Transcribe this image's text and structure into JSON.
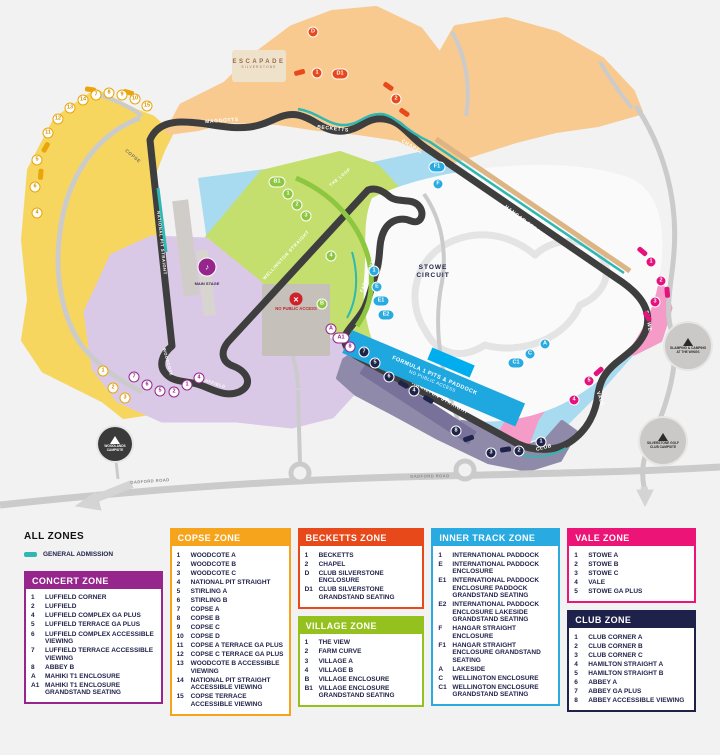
{
  "map": {
    "zone_colors": {
      "copse": "#E9A50A",
      "concert": "#96268C",
      "becketts": "#E8491B",
      "village": "#8DC63F",
      "inner": "#29ABE2",
      "vale": "#E5127D",
      "club": "#1F2349",
      "general_admission": "#2FB8B1"
    },
    "special": {
      "banner_line1": "FORMULA 1 PITS & PADDOCK",
      "banner_line2": "NO PUBLIC ACCESS",
      "stowe_line1": "STOWE",
      "stowe_line2": "CIRCUIT",
      "escapade_line1": "ESCAPADE",
      "escapade_line2": "SILVERSTONE",
      "main_stage": "MAIN STAGE",
      "no_access": "NO PUBLIC ACCESS"
    },
    "labels": [
      {
        "t": "MAGGOTTS",
        "x": 222,
        "y": 121,
        "r": -4,
        "c": "light",
        "s": 5
      },
      {
        "t": "BECKETTS",
        "x": 333,
        "y": 129,
        "r": 6,
        "c": "light",
        "s": 5
      },
      {
        "t": "CHAPEL",
        "x": 412,
        "y": 147,
        "r": 30,
        "c": "light",
        "s": 5
      },
      {
        "t": "HANGAR STRAIGHT",
        "x": 528,
        "y": 224,
        "r": 37,
        "c": "light",
        "s": 5
      },
      {
        "t": "STOWE",
        "x": 648,
        "y": 321,
        "r": 80,
        "c": "light",
        "s": 5
      },
      {
        "t": "VALE",
        "x": 600,
        "y": 399,
        "r": 72,
        "c": "light",
        "s": 5
      },
      {
        "t": "CLUB",
        "x": 544,
        "y": 448,
        "r": -14,
        "c": "light",
        "s": 5
      },
      {
        "t": "HAMILTON STRAIGHT",
        "x": 440,
        "y": 398,
        "r": 29,
        "c": "light",
        "s": 5
      },
      {
        "t": "WELLINGTON STRAIGHT",
        "x": 286,
        "y": 255,
        "r": -47,
        "c": "light",
        "s": 4.5
      },
      {
        "t": "THE LOOP",
        "x": 340,
        "y": 177,
        "r": -40,
        "c": "light",
        "s": 4.2
      },
      {
        "t": "FARM CURVE",
        "x": 367,
        "y": 276,
        "r": -70,
        "c": "light",
        "s": 4.2
      },
      {
        "t": "NATIONAL PIT STRAIGHT",
        "x": 162,
        "y": 243,
        "r": 84,
        "c": "light",
        "s": 4.2
      },
      {
        "t": "COPSE",
        "x": 133,
        "y": 156,
        "r": 40,
        "c": "dark",
        "s": 4.5
      },
      {
        "t": "LUFFIELD",
        "x": 214,
        "y": 383,
        "r": 18,
        "c": "light",
        "s": 4
      },
      {
        "t": "WOODCOTE",
        "x": 168,
        "y": 362,
        "r": 75,
        "c": "light",
        "s": 4
      },
      {
        "t": "DADFORD ROAD",
        "x": 150,
        "y": 481,
        "r": -4,
        "c": "roadlabel",
        "s": 4.2
      },
      {
        "t": "DADFORD ROAD",
        "x": 430,
        "y": 476,
        "r": -1,
        "c": "roadlabel",
        "s": 4.2
      }
    ],
    "markers": [
      {
        "z": "copse",
        "t": "11",
        "x": 48,
        "y": 133
      },
      {
        "z": "copse",
        "t": "12",
        "x": 58,
        "y": 119
      },
      {
        "z": "copse",
        "t": "13",
        "x": 70,
        "y": 108
      },
      {
        "z": "copse",
        "t": "14",
        "x": 83,
        "y": 100
      },
      {
        "z": "copse",
        "t": "7",
        "x": 96,
        "y": 95
      },
      {
        "z": "copse",
        "t": "8",
        "x": 109,
        "y": 93
      },
      {
        "z": "copse",
        "t": "9",
        "x": 122,
        "y": 95
      },
      {
        "z": "copse",
        "t": "10",
        "x": 135,
        "y": 99
      },
      {
        "z": "copse",
        "t": "15",
        "x": 147,
        "y": 106
      },
      {
        "z": "copse",
        "t": "5",
        "x": 37,
        "y": 160
      },
      {
        "z": "copse",
        "t": "6",
        "x": 35,
        "y": 187
      },
      {
        "z": "copse",
        "t": "4",
        "x": 37,
        "y": 213
      },
      {
        "z": "copse",
        "t": "1",
        "x": 103,
        "y": 371
      },
      {
        "z": "copse",
        "t": "2",
        "x": 113,
        "y": 388
      },
      {
        "z": "copse",
        "t": "3",
        "x": 125,
        "y": 398
      },
      {
        "z": "copse",
        "b": true,
        "x": 45,
        "y": 147,
        "r": -60
      },
      {
        "z": "copse",
        "b": true,
        "x": 90,
        "y": 89,
        "r": 8
      },
      {
        "z": "copse",
        "b": true,
        "x": 128,
        "y": 92,
        "r": 15
      },
      {
        "z": "copse",
        "b": true,
        "x": 40,
        "y": 174,
        "r": -85
      },
      {
        "z": "concert",
        "t": "7",
        "x": 134,
        "y": 377
      },
      {
        "z": "concert",
        "t": "6",
        "x": 147,
        "y": 385
      },
      {
        "z": "concert",
        "t": "5",
        "x": 160,
        "y": 391
      },
      {
        "z": "concert",
        "t": "2",
        "x": 174,
        "y": 392
      },
      {
        "z": "concert",
        "t": "1",
        "x": 187,
        "y": 385
      },
      {
        "z": "concert",
        "t": "4",
        "x": 199,
        "y": 378
      },
      {
        "z": "concert",
        "t": "8",
        "x": 350,
        "y": 347
      },
      {
        "z": "concert",
        "t": "A",
        "x": 331,
        "y": 329
      },
      {
        "z": "concert",
        "t": "A1",
        "x": 341,
        "y": 338,
        "p": true
      },
      {
        "z": "becketts",
        "t": "D",
        "x": 313,
        "y": 32
      },
      {
        "z": "becketts",
        "t": "1",
        "x": 317,
        "y": 73
      },
      {
        "z": "becketts",
        "t": "D1",
        "x": 340,
        "y": 74,
        "p": true
      },
      {
        "z": "becketts",
        "t": "2",
        "x": 396,
        "y": 99
      },
      {
        "z": "becketts",
        "b": true,
        "x": 299,
        "y": 72,
        "r": -15
      },
      {
        "z": "becketts",
        "b": true,
        "x": 388,
        "y": 86,
        "r": 35
      },
      {
        "z": "becketts",
        "b": true,
        "x": 404,
        "y": 112,
        "r": 35
      },
      {
        "z": "village",
        "t": "B1",
        "x": 277,
        "y": 182,
        "p": true
      },
      {
        "z": "village",
        "t": "1",
        "x": 288,
        "y": 194
      },
      {
        "z": "village",
        "t": "2",
        "x": 297,
        "y": 205
      },
      {
        "z": "village",
        "t": "3",
        "x": 306,
        "y": 216
      },
      {
        "z": "village",
        "t": "4",
        "x": 331,
        "y": 256
      },
      {
        "z": "village",
        "t": "B",
        "x": 322,
        "y": 304
      },
      {
        "z": "inner",
        "t": "F1",
        "x": 437,
        "y": 167,
        "p": true
      },
      {
        "z": "inner",
        "t": "F",
        "x": 438,
        "y": 184
      },
      {
        "z": "inner",
        "t": "1",
        "x": 374,
        "y": 271
      },
      {
        "z": "inner",
        "t": "E",
        "x": 377,
        "y": 287
      },
      {
        "z": "inner",
        "t": "E1",
        "x": 381,
        "y": 301,
        "p": true
      },
      {
        "z": "inner",
        "t": "E2",
        "x": 386,
        "y": 315,
        "p": true
      },
      {
        "z": "inner",
        "t": "A",
        "x": 545,
        "y": 344
      },
      {
        "z": "inner",
        "t": "C",
        "x": 530,
        "y": 354
      },
      {
        "z": "inner",
        "t": "C1",
        "x": 516,
        "y": 363,
        "p": true
      },
      {
        "z": "vale",
        "t": "1",
        "x": 651,
        "y": 262
      },
      {
        "z": "vale",
        "t": "2",
        "x": 661,
        "y": 281
      },
      {
        "z": "vale",
        "t": "3",
        "x": 655,
        "y": 302
      },
      {
        "z": "vale",
        "t": "5",
        "x": 589,
        "y": 381
      },
      {
        "z": "vale",
        "t": "4",
        "x": 574,
        "y": 400
      },
      {
        "z": "vale",
        "b": true,
        "x": 642,
        "y": 251,
        "r": 40
      },
      {
        "z": "vale",
        "b": true,
        "x": 667,
        "y": 292,
        "r": 85
      },
      {
        "z": "vale",
        "b": true,
        "x": 647,
        "y": 316,
        "r": 60
      },
      {
        "z": "vale",
        "b": true,
        "x": 598,
        "y": 371,
        "r": -42
      },
      {
        "z": "club",
        "t": "7",
        "x": 364,
        "y": 352
      },
      {
        "z": "club",
        "t": "5",
        "x": 375,
        "y": 363
      },
      {
        "z": "club",
        "t": "6",
        "x": 389,
        "y": 377
      },
      {
        "z": "club",
        "t": "4",
        "x": 414,
        "y": 391
      },
      {
        "z": "club",
        "t": "8",
        "x": 456,
        "y": 431
      },
      {
        "z": "club",
        "t": "3",
        "x": 491,
        "y": 453
      },
      {
        "z": "club",
        "t": "2",
        "x": 519,
        "y": 451
      },
      {
        "z": "club",
        "t": "1",
        "x": 541,
        "y": 442
      },
      {
        "z": "club",
        "b": true,
        "x": 403,
        "y": 384,
        "r": 30
      },
      {
        "z": "club",
        "b": true,
        "x": 428,
        "y": 399,
        "r": 30
      },
      {
        "z": "club",
        "b": true,
        "x": 468,
        "y": 438,
        "r": -18
      },
      {
        "z": "club",
        "b": true,
        "x": 505,
        "y": 449,
        "r": -8
      }
    ],
    "camps": [
      {
        "x": 115,
        "y": 444,
        "r": 17,
        "dark": true,
        "label": "WOODLANDS CAMPSITE"
      },
      {
        "x": 688,
        "y": 346,
        "r": 23,
        "dark": false,
        "label": "GLAMPING & CAMPING AT THE WINGS"
      },
      {
        "x": 663,
        "y": 441,
        "r": 23,
        "dark": false,
        "label": "SILVERSTONE GOLF CLUB CAMPSITE"
      }
    ]
  },
  "legend": {
    "columns": [
      [
        "all",
        "concert"
      ],
      [
        "copse"
      ],
      [
        "becketts",
        "village"
      ],
      [
        "inner"
      ],
      [
        "vale",
        "club"
      ]
    ],
    "zones": {
      "all": {
        "title": "ALL ZONES",
        "ga": true,
        "ga_label": "GENERAL ADMISSION",
        "color": "#2FB8B1",
        "items": []
      },
      "concert": {
        "title": "CONCERT ZONE",
        "color": "#96268C",
        "items": [
          [
            "1",
            "LUFFIELD CORNER"
          ],
          [
            "2",
            "LUFFIELD"
          ],
          [
            "4",
            "LUFFIELD COMPLEX GA PLUS"
          ],
          [
            "5",
            "LUFFIELD TERRACE GA PLUS"
          ],
          [
            "6",
            "LUFFIELD COMPLEX ACCESSIBLE VIEWING"
          ],
          [
            "7",
            "LUFFIELD TERRACE ACCESSIBLE VIEWING"
          ],
          [
            "8",
            "ABBEY B"
          ],
          [
            "A",
            "MAHIKI T1 ENCLOSURE"
          ],
          [
            "A1",
            "MAHIKI T1 ENCLOSURE GRANDSTAND SEATING"
          ]
        ]
      },
      "copse": {
        "title": "COPSE ZONE",
        "color": "#F7A41D",
        "items": [
          [
            "1",
            "WOODCOTE A"
          ],
          [
            "2",
            "WOODCOTE B"
          ],
          [
            "3",
            "WOODCOTE C"
          ],
          [
            "4",
            "NATIONAL PIT STRAIGHT"
          ],
          [
            "5",
            "STIRLING A"
          ],
          [
            "6",
            "STIRLING B"
          ],
          [
            "7",
            "COPSE A"
          ],
          [
            "8",
            "COPSE B"
          ],
          [
            "9",
            "COPSE C"
          ],
          [
            "10",
            "COPSE D"
          ],
          [
            "11",
            "COPSE A TERRACE GA PLUS"
          ],
          [
            "12",
            "COPSE C TERRACE GA PLUS"
          ],
          [
            "13",
            "WOODCOTE B ACCESSIBLE VIEWING"
          ],
          [
            "14",
            "NATIONAL PIT STRAIGHT ACCESSIBLE VIEWING"
          ],
          [
            "15",
            "COPSE TERRACE ACCESSIBLE VIEWING"
          ]
        ]
      },
      "becketts": {
        "title": "BECKETTS ZONE",
        "color": "#E8491B",
        "items": [
          [
            "1",
            "BECKETTS"
          ],
          [
            "2",
            "CHAPEL"
          ],
          [
            "D",
            "CLUB SILVERSTONE ENCLOSURE"
          ],
          [
            "D1",
            "CLUB SILVERSTONE GRANDSTAND SEATING"
          ]
        ]
      },
      "village": {
        "title": "VILLAGE ZONE",
        "color": "#95C11F",
        "items": [
          [
            "1",
            "THE VIEW"
          ],
          [
            "2",
            "FARM CURVE"
          ],
          [
            "3",
            "VILLAGE A"
          ],
          [
            "4",
            "VILLAGE B"
          ],
          [
            "B",
            "VILLAGE ENCLOSURE"
          ],
          [
            "B1",
            "VILLAGE ENCLOSURE GRANDSTAND SEATING"
          ]
        ]
      },
      "inner": {
        "title": "INNER TRACK ZONE",
        "color": "#29ABE2",
        "items": [
          [
            "1",
            "INTERNATIONAL PADDOCK"
          ],
          [
            "E",
            "INTERNATIONAL PADDOCK ENCLOSURE"
          ],
          [
            "E1",
            "INTERNATIONAL PADDOCK ENCLOSURE PADDOCK GRANDSTAND SEATING"
          ],
          [
            "E2",
            "INTERNATIONAL PADDOCK ENCLOSURE LAKESIDE GRANDSTAND SEATING"
          ],
          [
            "F",
            "HANGAR STRAIGHT ENCLOSURE"
          ],
          [
            "F1",
            "HANGAR STRAIGHT ENCLOSURE GRANDSTAND SEATING"
          ],
          [
            "A",
            "LAKESIDE"
          ],
          [
            "C",
            "WELLINGTON ENCLOSURE"
          ],
          [
            "C1",
            "WELLINGTON ENCLOSURE GRANDSTAND SEATING"
          ]
        ]
      },
      "vale": {
        "title": "VALE ZONE",
        "color": "#EC1577",
        "items": [
          [
            "1",
            "STOWE A"
          ],
          [
            "2",
            "STOWE B"
          ],
          [
            "3",
            "STOWE C"
          ],
          [
            "4",
            "VALE"
          ],
          [
            "5",
            "STOWE GA PLUS"
          ]
        ]
      },
      "club": {
        "title": "CLUB ZONE",
        "color": "#1E2149",
        "items": [
          [
            "1",
            "CLUB CORNER A"
          ],
          [
            "2",
            "CLUB CORNER B"
          ],
          [
            "3",
            "CLUB CORNER C"
          ],
          [
            "4",
            "HAMILTON STRAIGHT A"
          ],
          [
            "5",
            "HAMILTON STRAIGHT B"
          ],
          [
            "6",
            "ABBEY A"
          ],
          [
            "7",
            "ABBEY GA PLUS"
          ],
          [
            "8",
            "ABBEY ACCESSIBLE VIEWING"
          ]
        ]
      }
    }
  }
}
